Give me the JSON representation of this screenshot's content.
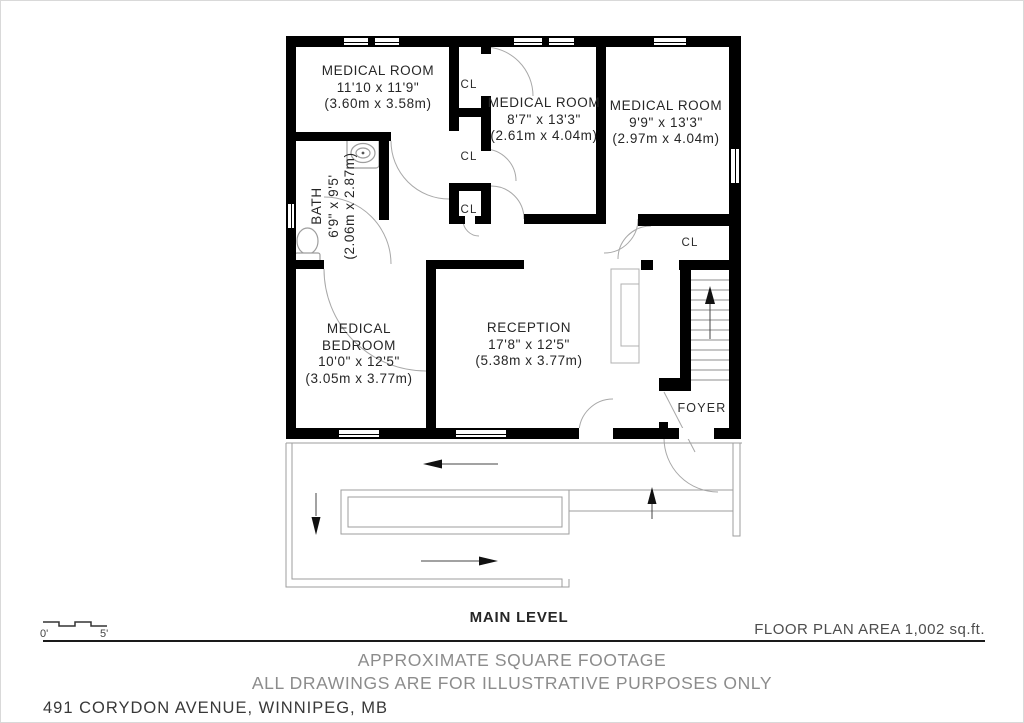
{
  "plan": {
    "level_label": "MAIN LEVEL",
    "area_label": "FLOOR PLAN AREA 1,002 sq.ft.",
    "disclaimer_line1": "APPROXIMATE SQUARE FOOTAGE",
    "disclaimer_line2": "ALL DRAWINGS ARE FOR ILLUSTRATIVE PURPOSES ONLY",
    "address": "491 CORYDON AVENUE, WINNIPEG, MB",
    "scale": {
      "start": "0'",
      "end": "5'"
    },
    "closet_label": "CL",
    "rooms": {
      "medical_room_top_left": {
        "name": "MEDICAL ROOM",
        "imperial": "11'10 x 11'9\"",
        "metric": "(3.60m x 3.58m)"
      },
      "medical_room_top_middle": {
        "name": "MEDICAL ROOM",
        "imperial": "8'7\" x 13'3\"",
        "metric": "(2.61m x 4.04m)"
      },
      "medical_room_top_right": {
        "name": "MEDICAL ROOM",
        "imperial": "9'9\" x 13'3\"",
        "metric": "(2.97m x 4.04m)"
      },
      "bath": {
        "name": "BATH",
        "imperial": "6'9\" x 9'5'",
        "metric": "(2.06m x 2.87m)"
      },
      "medical_bedroom": {
        "name": "MEDICAL BEDROOM",
        "imperial": "10'0\" x 12'5\"",
        "metric": "(3.05m x 3.77m)"
      },
      "reception": {
        "name": "RECEPTION",
        "imperial": "17'8\" x 12'5\"",
        "metric": "(5.38m x 3.77m)"
      },
      "foyer": {
        "name": "FOYER"
      }
    },
    "colors": {
      "wall": "#000000",
      "thin_line": "#9e9e9e",
      "text": "#262626",
      "muted_text": "#8c8c8c"
    }
  }
}
